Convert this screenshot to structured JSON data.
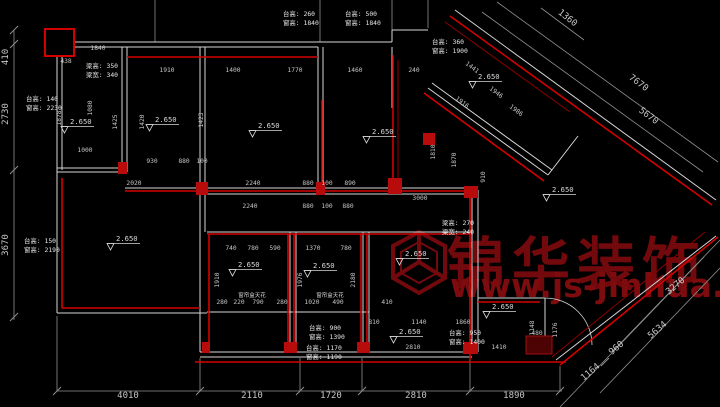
{
  "canvas": {
    "width": 720,
    "height": 407,
    "background": "#000000"
  },
  "colors": {
    "wall": "#d6d6d6",
    "dim_line": "#8f8f8f",
    "dim_text": "#c6c6c6",
    "annotation_text": "#e8e8e8",
    "red_bright": "#d40000",
    "red_mid": "#8f0000",
    "watermark_red": "#72090c"
  },
  "watermark": {
    "logo": "cube-logo",
    "brand": "锦华装饰",
    "url": "www.js-jinhua.com"
  },
  "plan": {
    "level_label": "2.650",
    "levels": [
      {
        "x": 70,
        "y": 124
      },
      {
        "x": 155,
        "y": 122
      },
      {
        "x": 258,
        "y": 128
      },
      {
        "x": 372,
        "y": 134
      },
      {
        "x": 478,
        "y": 79
      },
      {
        "x": 552,
        "y": 192
      },
      {
        "x": 116,
        "y": 241
      },
      {
        "x": 238,
        "y": 267
      },
      {
        "x": 313,
        "y": 268
      },
      {
        "x": 405,
        "y": 256
      },
      {
        "x": 399,
        "y": 334
      },
      {
        "x": 492,
        "y": 309
      }
    ],
    "annotations": [
      {
        "x": 86,
        "y": 68,
        "lines": [
          "梁高: 350",
          "梁宽: 340"
        ]
      },
      {
        "x": 26,
        "y": 101,
        "lines": [
          "台高: 140",
          "窗高: 2230"
        ]
      },
      {
        "x": 283,
        "y": 16,
        "lines": [
          "台高: 260",
          "窗高: 1840"
        ]
      },
      {
        "x": 345,
        "y": 16,
        "lines": [
          "台高: 500",
          "窗高: 1840"
        ]
      },
      {
        "x": 432,
        "y": 44,
        "lines": [
          "台高: 360",
          "窗高: 1900"
        ]
      },
      {
        "x": 24,
        "y": 243,
        "lines": [
          "台高: 150",
          "窗高: 2190"
        ]
      },
      {
        "x": 442,
        "y": 225,
        "lines": [
          "梁高: 270",
          "梁宽: 240"
        ]
      },
      {
        "x": 309,
        "y": 330,
        "lines": [
          "台高: 900",
          "窗高: 1390"
        ]
      },
      {
        "x": 306,
        "y": 350,
        "lines": [
          "台高: 1170",
          "窗高: 1190"
        ]
      },
      {
        "x": 449,
        "y": 335,
        "lines": [
          "台高: 950",
          "窗高: 1400"
        ]
      }
    ],
    "dims": [
      {
        "t": "410",
        "x": 8,
        "y": 57,
        "r": -90,
        "s": 9
      },
      {
        "t": "2730",
        "x": 8,
        "y": 114,
        "r": -90,
        "s": 9
      },
      {
        "t": "3670",
        "x": 8,
        "y": 245,
        "r": -90,
        "s": 9
      },
      {
        "t": "4010",
        "x": 128,
        "y": 398,
        "s": 9
      },
      {
        "t": "2110",
        "x": 252,
        "y": 398,
        "s": 9
      },
      {
        "t": "1720",
        "x": 331,
        "y": 398,
        "s": 9
      },
      {
        "t": "2810",
        "x": 416,
        "y": 398,
        "s": 9
      },
      {
        "t": "1890",
        "x": 514,
        "y": 398,
        "s": 9
      },
      {
        "t": "1360",
        "x": 566,
        "y": 20,
        "r": 38,
        "s": 9
      },
      {
        "t": "7670",
        "x": 637,
        "y": 85,
        "r": 37,
        "s": 9
      },
      {
        "t": "5670",
        "x": 647,
        "y": 118,
        "r": 37,
        "s": 9
      },
      {
        "t": "3270",
        "x": 677,
        "y": 288,
        "r": -40,
        "s": 9
      },
      {
        "t": "5634",
        "x": 659,
        "y": 332,
        "r": -40,
        "s": 9
      },
      {
        "t": "960",
        "x": 618,
        "y": 350,
        "r": -40,
        "s": 9
      },
      {
        "t": "1164",
        "x": 592,
        "y": 374,
        "r": -40,
        "s": 9
      },
      {
        "t": "1840",
        "x": 98,
        "y": 50
      },
      {
        "t": "438",
        "x": 66,
        "y": 63
      },
      {
        "t": "1910",
        "x": 167,
        "y": 72
      },
      {
        "t": "1400",
        "x": 233,
        "y": 72
      },
      {
        "t": "1770",
        "x": 295,
        "y": 72
      },
      {
        "t": "1460",
        "x": 355,
        "y": 72
      },
      {
        "t": "240",
        "x": 414,
        "y": 72
      },
      {
        "t": "1080",
        "x": 92,
        "y": 108,
        "r": -90
      },
      {
        "t": "1878",
        "x": 61,
        "y": 118,
        "r": -90
      },
      {
        "t": "1425",
        "x": 117,
        "y": 122,
        "r": -90
      },
      {
        "t": "1420",
        "x": 144,
        "y": 122,
        "r": -90
      },
      {
        "t": "1423",
        "x": 203,
        "y": 120,
        "r": -90
      },
      {
        "t": "1000",
        "x": 85,
        "y": 152
      },
      {
        "t": "930",
        "x": 152,
        "y": 163
      },
      {
        "t": "880",
        "x": 184,
        "y": 163
      },
      {
        "t": "100",
        "x": 202,
        "y": 163
      },
      {
        "t": "2020",
        "x": 134,
        "y": 185
      },
      {
        "t": "2240",
        "x": 253,
        "y": 185
      },
      {
        "t": "880",
        "x": 308,
        "y": 185
      },
      {
        "t": "100",
        "x": 327,
        "y": 185
      },
      {
        "t": "890",
        "x": 350,
        "y": 185
      },
      {
        "t": "2240",
        "x": 250,
        "y": 208
      },
      {
        "t": "880",
        "x": 308,
        "y": 208
      },
      {
        "t": "100",
        "x": 327,
        "y": 208
      },
      {
        "t": "880",
        "x": 348,
        "y": 208
      },
      {
        "t": "3000",
        "x": 420,
        "y": 200
      },
      {
        "t": "740",
        "x": 231,
        "y": 250
      },
      {
        "t": "780",
        "x": 253,
        "y": 250
      },
      {
        "t": "590",
        "x": 275,
        "y": 250
      },
      {
        "t": "1370",
        "x": 313,
        "y": 250
      },
      {
        "t": "780",
        "x": 346,
        "y": 250
      },
      {
        "t": "1910",
        "x": 219,
        "y": 280,
        "r": -90
      },
      {
        "t": "1976",
        "x": 302,
        "y": 280,
        "r": -90
      },
      {
        "t": "2180",
        "x": 355,
        "y": 280,
        "r": -90
      },
      {
        "t": "280",
        "x": 222,
        "y": 304
      },
      {
        "t": "220",
        "x": 239,
        "y": 304
      },
      {
        "t": "790",
        "x": 258,
        "y": 304
      },
      {
        "t": "280",
        "x": 282,
        "y": 304
      },
      {
        "t": "1020",
        "x": 312,
        "y": 304
      },
      {
        "t": "490",
        "x": 338,
        "y": 304
      },
      {
        "t": "410",
        "x": 387,
        "y": 304
      },
      {
        "t": "窗帘盒天花",
        "x": 252,
        "y": 297,
        "s": 5.5,
        "c": "#dadada"
      },
      {
        "t": "窗帘盒天花",
        "x": 330,
        "y": 297,
        "s": 5.5,
        "c": "#dadada"
      },
      {
        "t": "810",
        "x": 374,
        "y": 324
      },
      {
        "t": "1140",
        "x": 419,
        "y": 324
      },
      {
        "t": "1860",
        "x": 463,
        "y": 324
      },
      {
        "t": "2810",
        "x": 413,
        "y": 349
      },
      {
        "t": "1410",
        "x": 499,
        "y": 349
      },
      {
        "t": "480",
        "x": 537,
        "y": 335
      },
      {
        "t": "1148",
        "x": 534,
        "y": 328,
        "r": -90
      },
      {
        "t": "1176",
        "x": 557,
        "y": 330,
        "r": -90
      },
      {
        "t": "1441",
        "x": 471,
        "y": 69,
        "r": 37
      },
      {
        "t": "1916",
        "x": 461,
        "y": 104,
        "r": 37
      },
      {
        "t": "1946",
        "x": 495,
        "y": 94,
        "r": 37
      },
      {
        "t": "1986",
        "x": 515,
        "y": 112,
        "r": 37
      },
      {
        "t": "1810",
        "x": 435,
        "y": 152,
        "r": -90
      },
      {
        "t": "1870",
        "x": 456,
        "y": 160,
        "r": -90
      },
      {
        "t": "910",
        "x": 485,
        "y": 177,
        "r": -90
      }
    ]
  }
}
